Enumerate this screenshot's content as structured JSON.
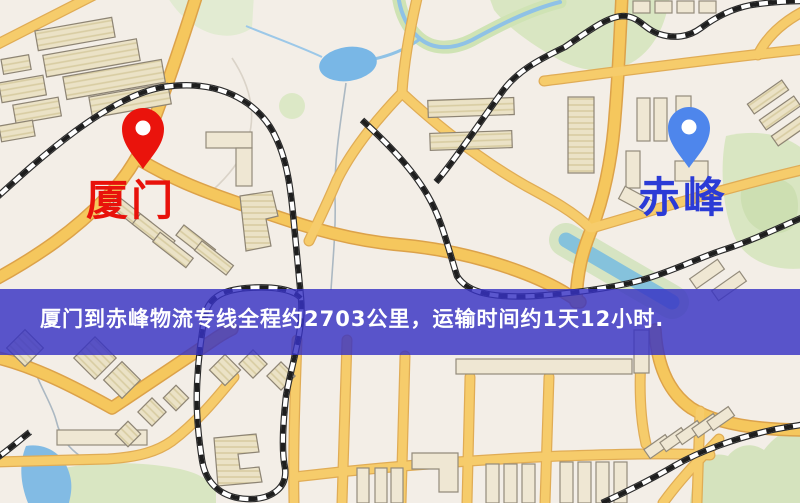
{
  "banner": {
    "text": "厦门到赤峰物流专线全程约2703公里，运输时间约1天12小时.",
    "background": "#3732C3",
    "opacity": "0.82",
    "text_color": "#FFFFFF"
  },
  "markers": {
    "origin": {
      "label": "厦门",
      "text_color": "#E8120B",
      "pin_color": "#EA130C",
      "pin_style": "red-map-pin"
    },
    "destination": {
      "label": "赤峰",
      "text_color": "#2B3BD6",
      "pin_color": "#4E86EC",
      "pin_style": "blue-map-pin"
    }
  },
  "route": {
    "origin": "厦门",
    "destination": "赤峰",
    "service": "物流专线",
    "distance_text": "约2703公里",
    "duration_text": "约1天12小时"
  },
  "map_colors": {
    "background": "#F3EEE7",
    "road_fill": "#F5C75D",
    "road_casing": "#DCA24A",
    "building_fill": "#EBE2C6",
    "building_outline": "#8D8474",
    "park_green": "#D9E6C2",
    "water_blue": "#82BBE4",
    "railway_dark": "#2B2B2B"
  }
}
